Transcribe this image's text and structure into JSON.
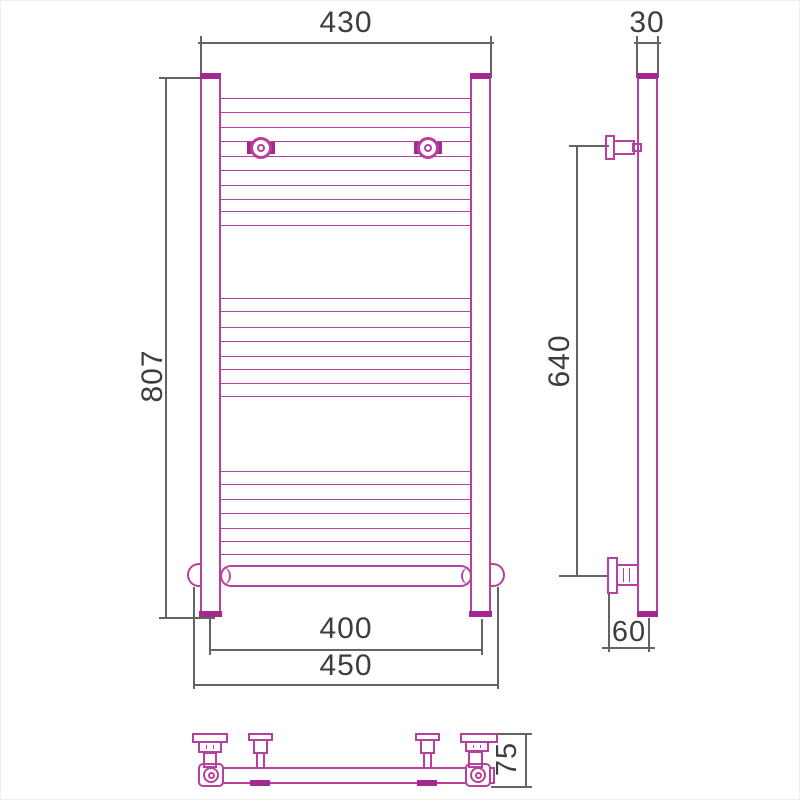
{
  "title": "Heated towel rail dimensional drawing",
  "colors": {
    "outline": "#b6409c",
    "outline_fill": "#a32990",
    "dimension": "#646464",
    "label": "#3d3d3d",
    "background": "#ffffff"
  },
  "dimensions": {
    "overall_width": {
      "value": "430"
    },
    "tube_depth": {
      "value": "30"
    },
    "overall_height": {
      "value": "807"
    },
    "bracket_span_height": {
      "value": "640"
    },
    "bottom_inner_width": {
      "value": "400"
    },
    "bottom_outer_width": {
      "value": "450"
    },
    "bottom_bracket_offset": {
      "value": "60"
    },
    "plan_depth": {
      "value": "75"
    }
  },
  "views": {
    "front": {
      "name": "front view",
      "rung_rows_y": [
        97,
        111,
        126,
        140,
        155,
        169,
        184,
        198,
        210,
        224,
        297,
        310,
        326,
        340,
        355,
        368,
        382,
        395,
        470,
        483,
        498,
        512,
        527,
        540,
        553
      ]
    },
    "side": {
      "name": "side view"
    },
    "plan": {
      "name": "top view"
    }
  }
}
